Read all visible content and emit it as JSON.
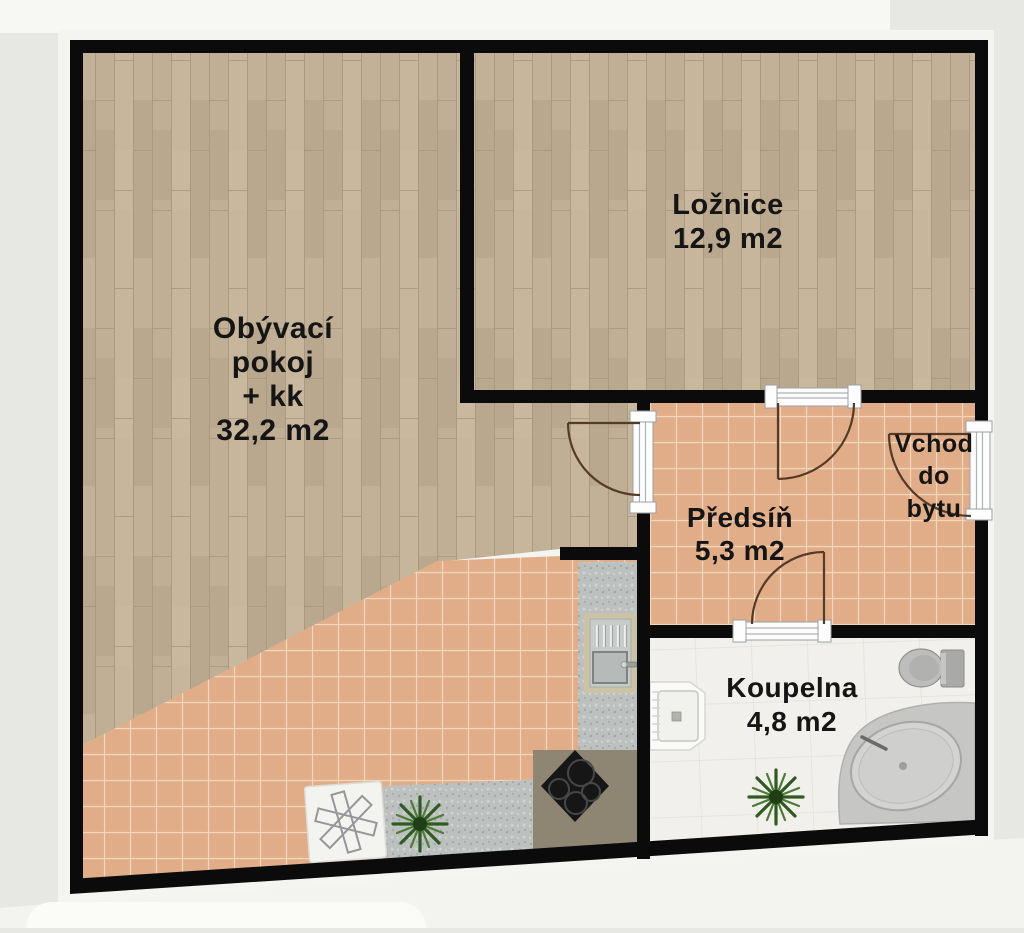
{
  "plan": {
    "type": "apartment-floor-plan",
    "rooms": [
      {
        "id": "living-room",
        "floor": "wood",
        "label_lines": [
          "Obývací",
          "pokoj",
          "+ kk",
          "32,2 m2"
        ],
        "name": "Obývací pokoj + kk",
        "area": "32,2 m2"
      },
      {
        "id": "bedroom",
        "floor": "wood",
        "label_lines": [
          "Ložnice",
          "12,9 m2"
        ],
        "name": "Ložnice",
        "area": "12,9 m2"
      },
      {
        "id": "hallway",
        "floor": "terracotta-tile",
        "label_lines": [
          "Předsíň",
          "5,3 m2"
        ],
        "name": "Předsíň",
        "area": "5,3 m2"
      },
      {
        "id": "bathroom",
        "floor": "light-tile",
        "label_lines": [
          "Koupelna",
          "4,8 m2"
        ],
        "name": "Koupelna",
        "area": "4,8 m2"
      },
      {
        "id": "entrance",
        "floor": "terracotta-tile",
        "label_lines": [
          "Vchod",
          "do",
          "bytu"
        ],
        "name": "Vchod do bytu"
      }
    ],
    "fixtures": [
      "kitchen-counter-granite",
      "kitchen-sink",
      "cooktop-stove",
      "rug-with-asterisk",
      "kitchen-plant",
      "bathroom-plant",
      "washbasin",
      "toilet",
      "corner-bathtub"
    ],
    "doors": [
      "living-room-to-hallway",
      "bedroom-to-hallway",
      "hallway-to-bathroom",
      "apartment-entrance"
    ],
    "colors": {
      "wall": "#0b0b0b",
      "wood_floor": "#c3b197",
      "tile_floor": "#e3b08c",
      "tile_grout": "#f1d7bc",
      "bath_floor": "#f1f0ec",
      "granite_counter": "#bcc0be",
      "tan_counter": "#8e8572",
      "door_swing": "#553a28",
      "plant_green": "#2f5a22",
      "label_text": "#151515"
    }
  }
}
